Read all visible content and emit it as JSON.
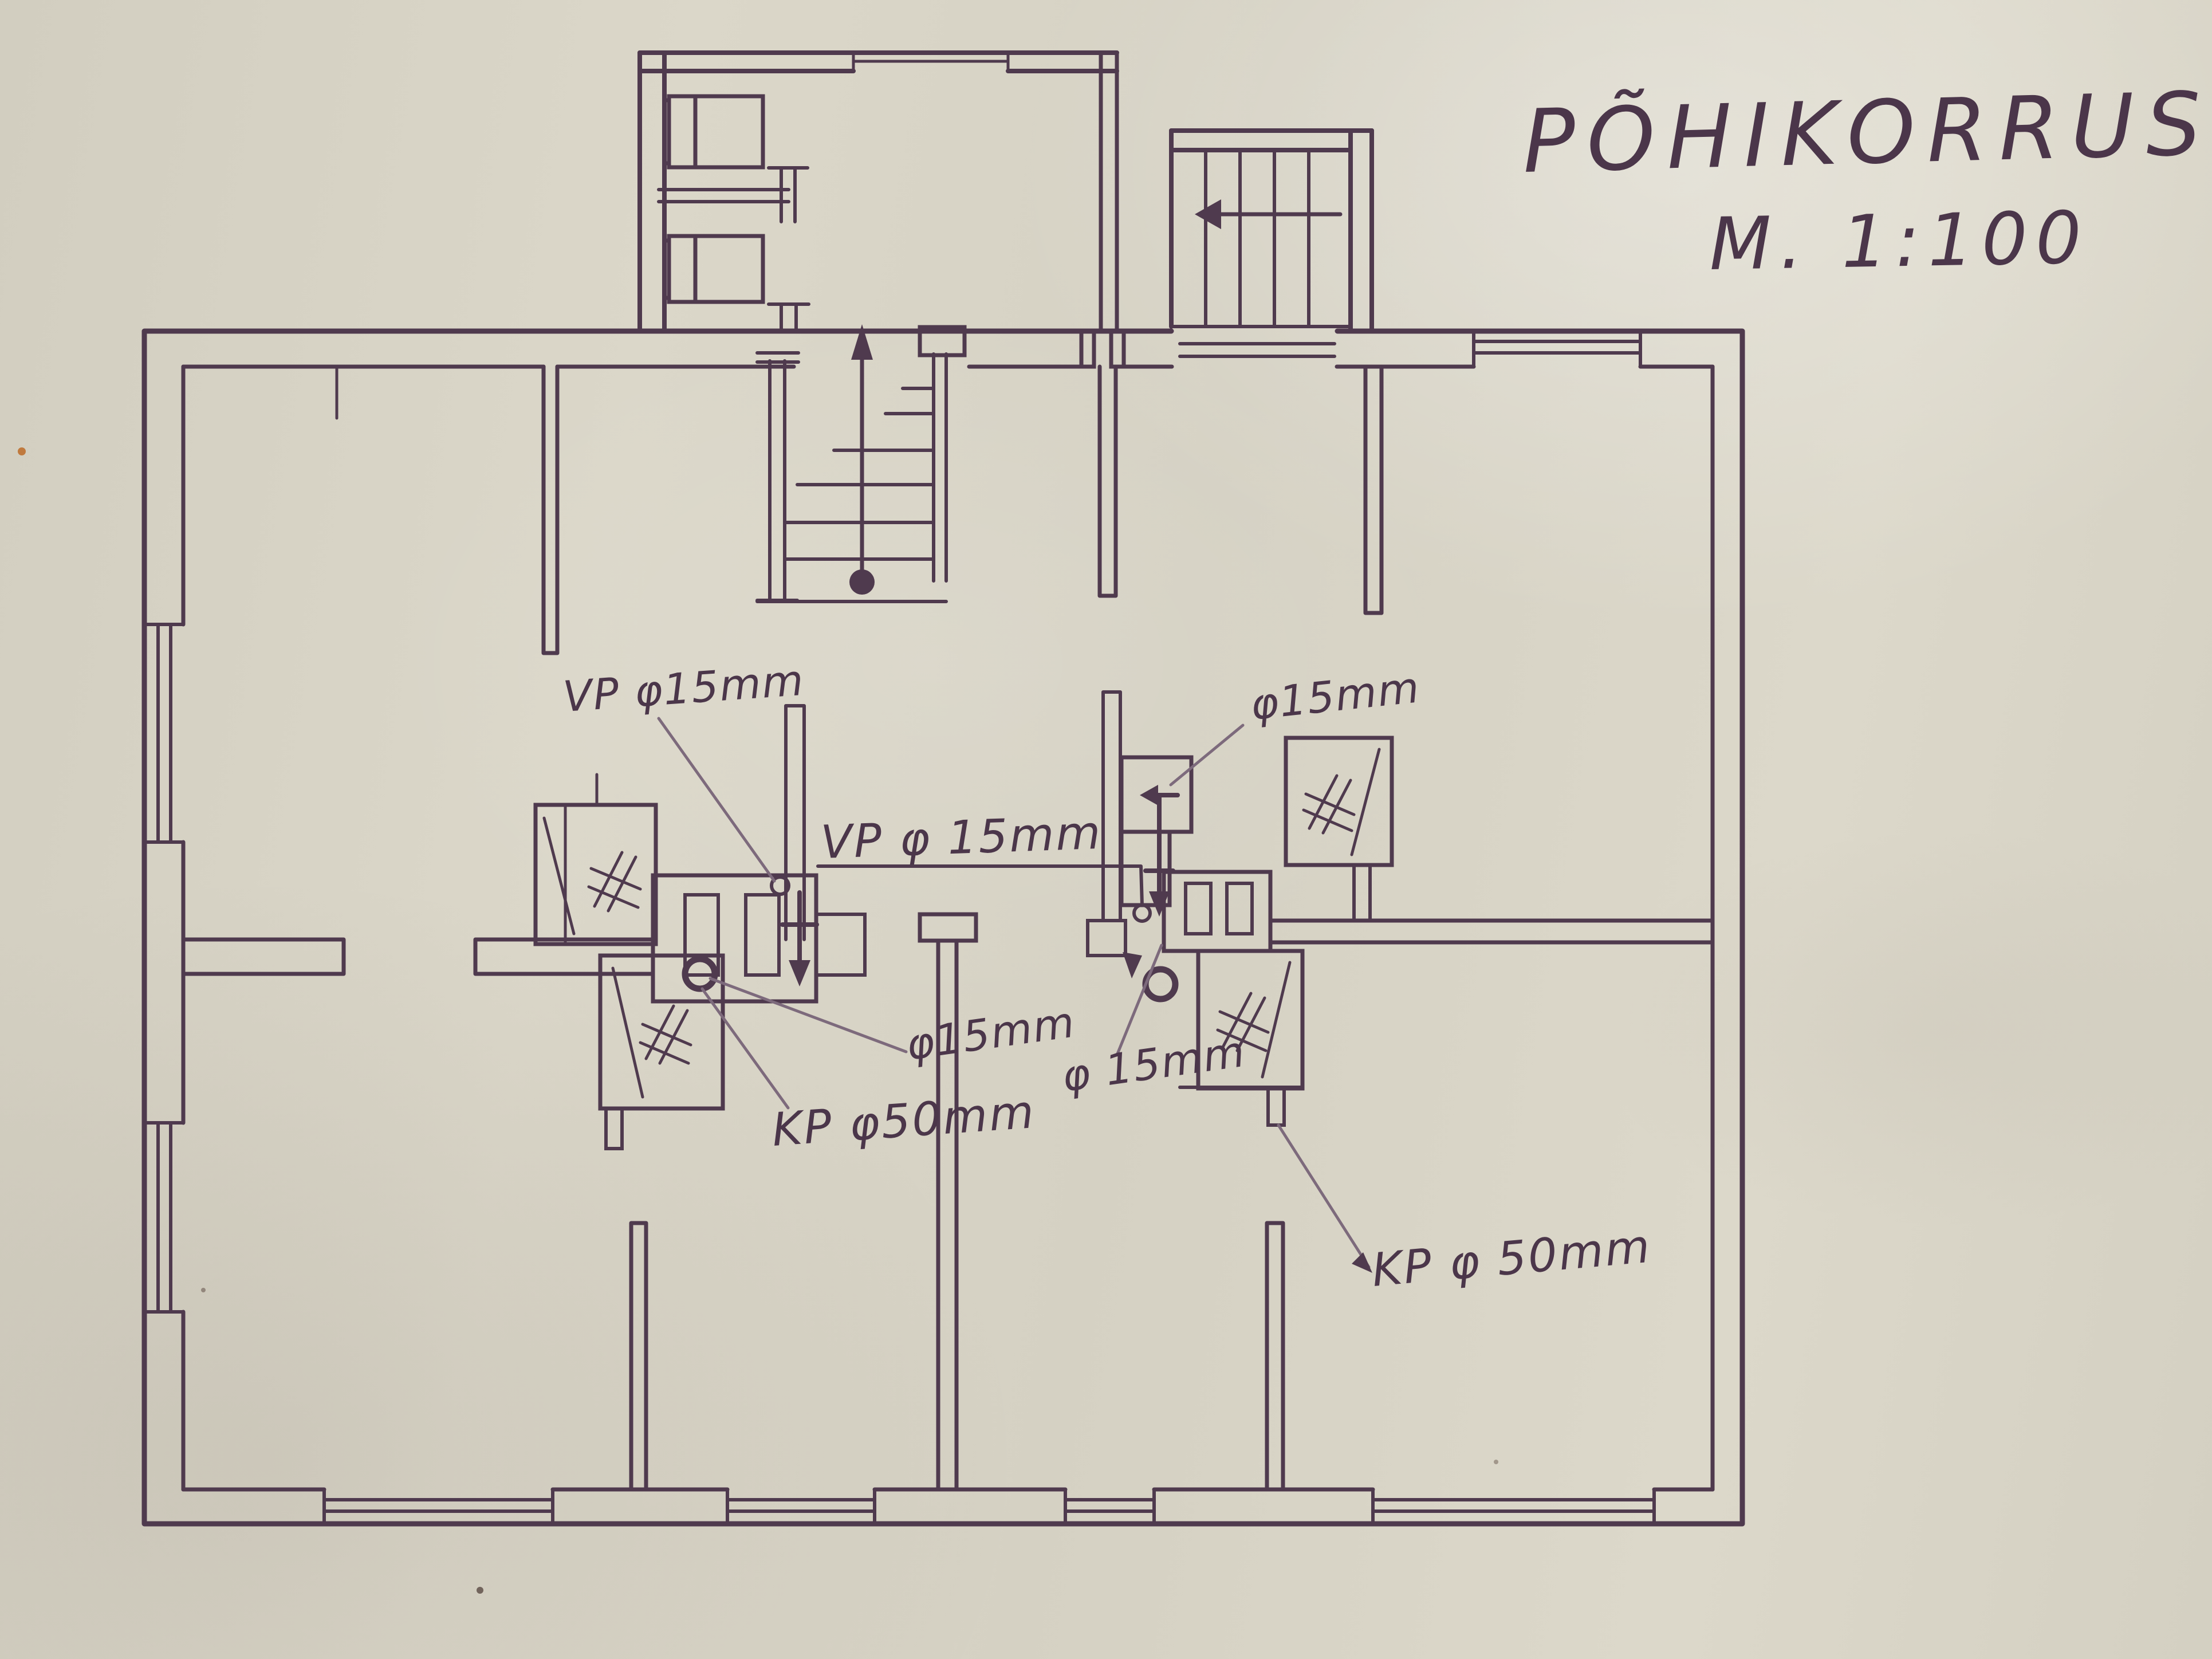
{
  "title": {
    "main": "PÕHIKORRUS",
    "scale": "M. 1:100"
  },
  "annotations": {
    "left_vp": "VP φ15mm",
    "center_vp": "VP φ 15mm",
    "left_phi15": "φ15mm",
    "left_kp50": "KP φ50mm",
    "right_phi15_upper": "φ15mm",
    "right_phi15_lower": "φ 15mm",
    "right_kp50": "KP φ 50mm"
  },
  "icons": {
    "stairs_up_arrow": "↑",
    "exterior_stairs_arrow": "←",
    "pipe_down_arrow": "↓",
    "floor_drain": "○",
    "fixture_hatch": "#"
  },
  "colors": {
    "ink": "#4f3a4e",
    "ink_faint": "#7d6a7c",
    "paper": "#d6d2c4"
  }
}
